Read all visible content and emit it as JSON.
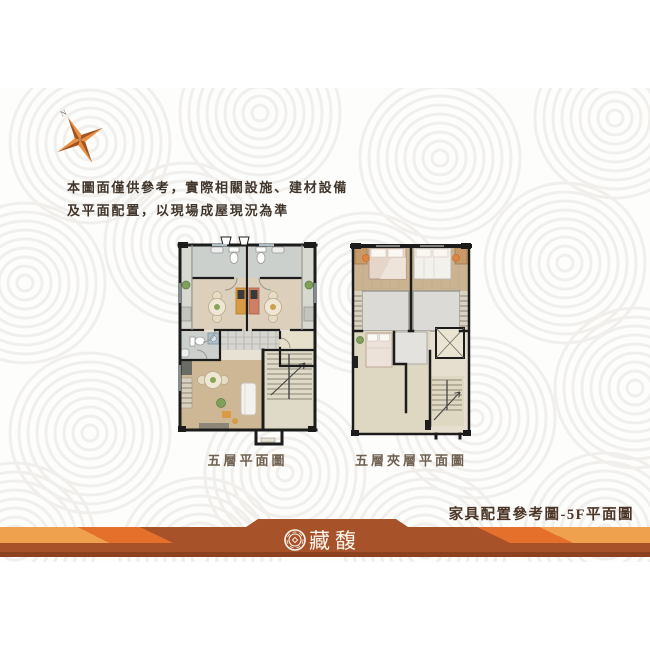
{
  "compass": {
    "label": "N"
  },
  "disclaimer": {
    "line1": "本圖面僅供參考，實際相關設施、建材設備",
    "line2": "及平面配置，以現場成屋現況為準"
  },
  "plans": {
    "left": {
      "caption": "五層平面圖"
    },
    "right": {
      "caption": "五層夾層平面圖"
    }
  },
  "footer": {
    "title": "家具配置參考圖-5F平面圖",
    "logo_text": "藏馥",
    "colors": {
      "bar": "#A8522A",
      "bar_dark": "#8C4120",
      "stripe_bright": "#E5702C",
      "stripe_light": "#F0A14E",
      "logo_ink": "#FAF6EF"
    }
  },
  "palette": {
    "page_bg": "#FFFFFF",
    "content_bg": "#FDFDFC",
    "pattern_ring": "#F1EFEC",
    "wall_ink": "#1C1C1C",
    "text_dark": "#41362C",
    "caption_brown": "#6F6152",
    "compass_orange": "#E89140"
  }
}
